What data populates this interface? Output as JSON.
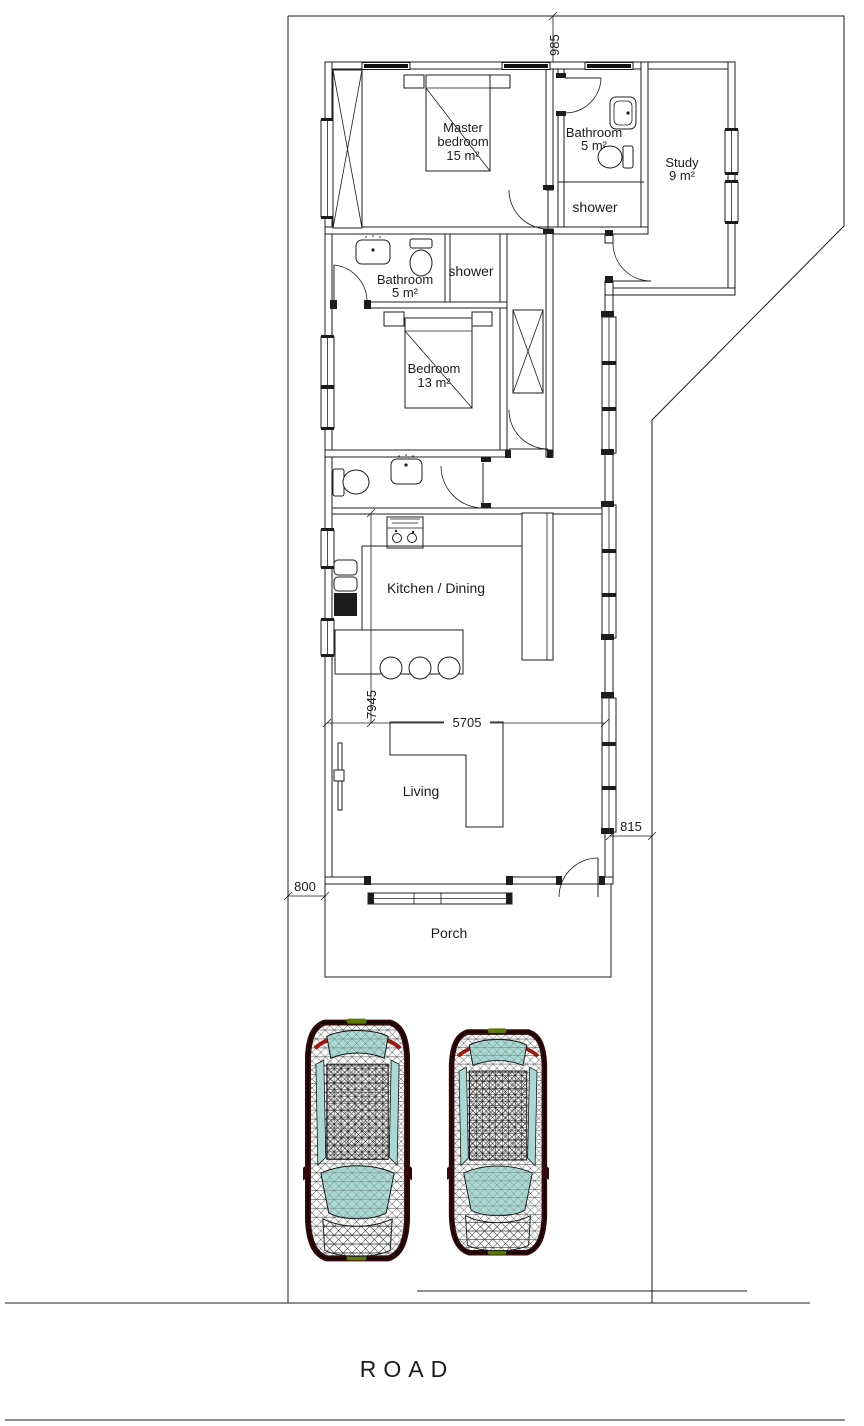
{
  "rooms": {
    "master_bedroom": {
      "line1": "Master",
      "line2": "bedroom",
      "area": "15 m²"
    },
    "bathroom_top": {
      "line1": "Bathroom",
      "area": "5 m²"
    },
    "shower_top": {
      "label": "shower"
    },
    "study": {
      "line1": "Study",
      "area": "9 m²"
    },
    "bathroom_mid": {
      "line1": "Bathroom",
      "area": "5 m²"
    },
    "shower_mid": {
      "label": "shower"
    },
    "bedroom": {
      "line1": "Bedroom",
      "area": "13 m²"
    },
    "kitchen_dining": {
      "label": "Kitchen / Dining"
    },
    "living": {
      "label": "Living"
    },
    "porch": {
      "label": "Porch"
    }
  },
  "dimensions": {
    "top_offset": "985",
    "interior_length": "7945",
    "interior_width": "5705",
    "right_offset": "815",
    "left_offset": "800"
  },
  "road": {
    "label": "ROAD"
  },
  "colors": {
    "line": "#1c1c1c",
    "car_body": "#330808",
    "car_window": "#a9d9d2",
    "car_accent_red": "#9b1b10",
    "car_accent_green": "#5d7a04"
  }
}
